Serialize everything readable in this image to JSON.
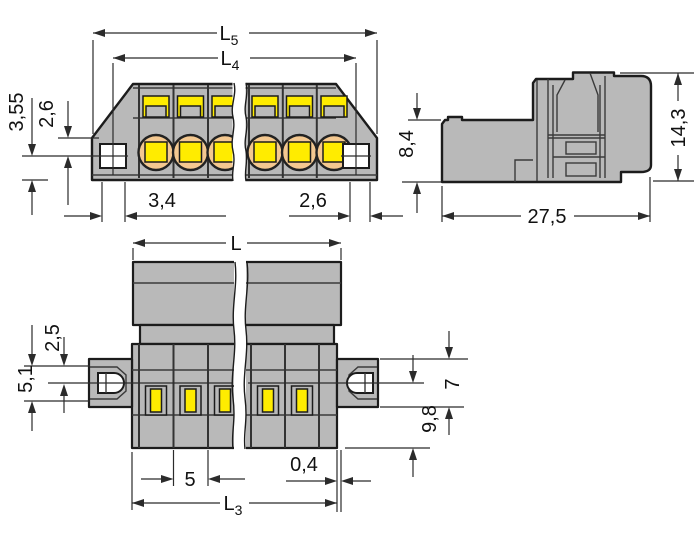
{
  "colors": {
    "bg": "#ffffff",
    "body": "#b9b9b9",
    "yellow": "#ffec00",
    "peach": "#f4c890",
    "outline": "#1c1c1c",
    "dim": "#2b2b2b"
  },
  "front_view": {
    "dims": {
      "l5": {
        "main": "L",
        "sub": "5"
      },
      "l4": {
        "main": "L",
        "sub": "4"
      },
      "height_355": "3,55",
      "height_26": "2,6",
      "width_34": "3,4",
      "width_26": "2,6"
    }
  },
  "side_view": {
    "dims": {
      "height_84": "8,4",
      "height_143": "14,3",
      "width_275": "27,5"
    }
  },
  "bottom_view": {
    "dims": {
      "l": "L",
      "offset_25": "2,5",
      "offset_51": "5,1",
      "flange_7": "7",
      "depth_98": "9,8",
      "pitch_5": "5",
      "gap_04": "0,4",
      "l3": {
        "main": "L",
        "sub": "3"
      }
    }
  }
}
